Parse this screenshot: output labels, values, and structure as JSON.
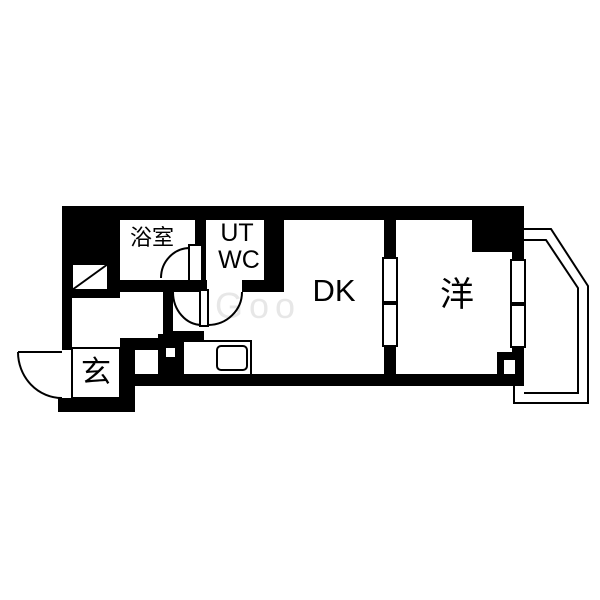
{
  "plan": {
    "rooms": {
      "bathroom": "浴室",
      "utility": "UT",
      "toilet": "WC",
      "dining_kitchen": "DK",
      "western_room": "洋",
      "entrance": "玄"
    },
    "watermark": "Goo",
    "colors": {
      "wall": "#000000",
      "floor": "#ffffff",
      "watermark": "#e7e7e7"
    }
  }
}
